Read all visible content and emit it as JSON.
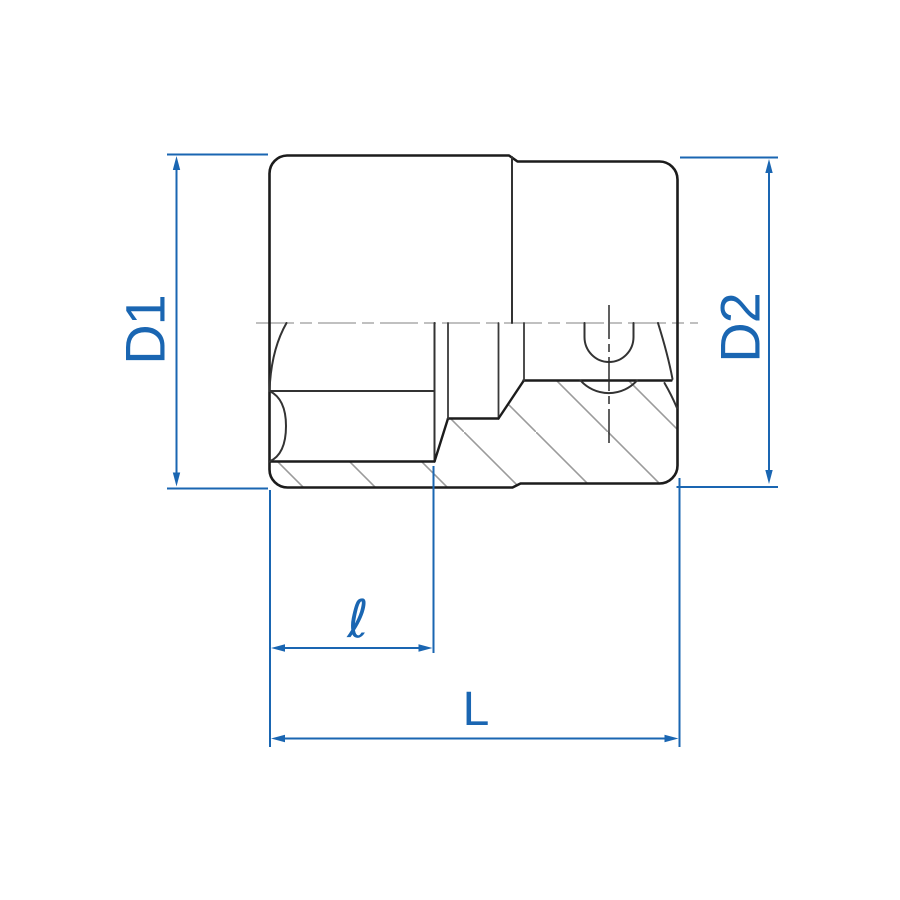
{
  "drawing": {
    "type": "technical-dimension-diagram",
    "subject": "socket wrench socket, side half-section view",
    "labels": {
      "d1": "D1",
      "d2": "D2",
      "ell": "ℓ",
      "l": "L"
    }
  },
  "colors": {
    "dimension_blue": "#1a66b2",
    "outline_black": "#1c1c1c",
    "hatch_gray": "#9b9b9b",
    "centerline_gray": "#ababab",
    "background": "#ffffff"
  }
}
